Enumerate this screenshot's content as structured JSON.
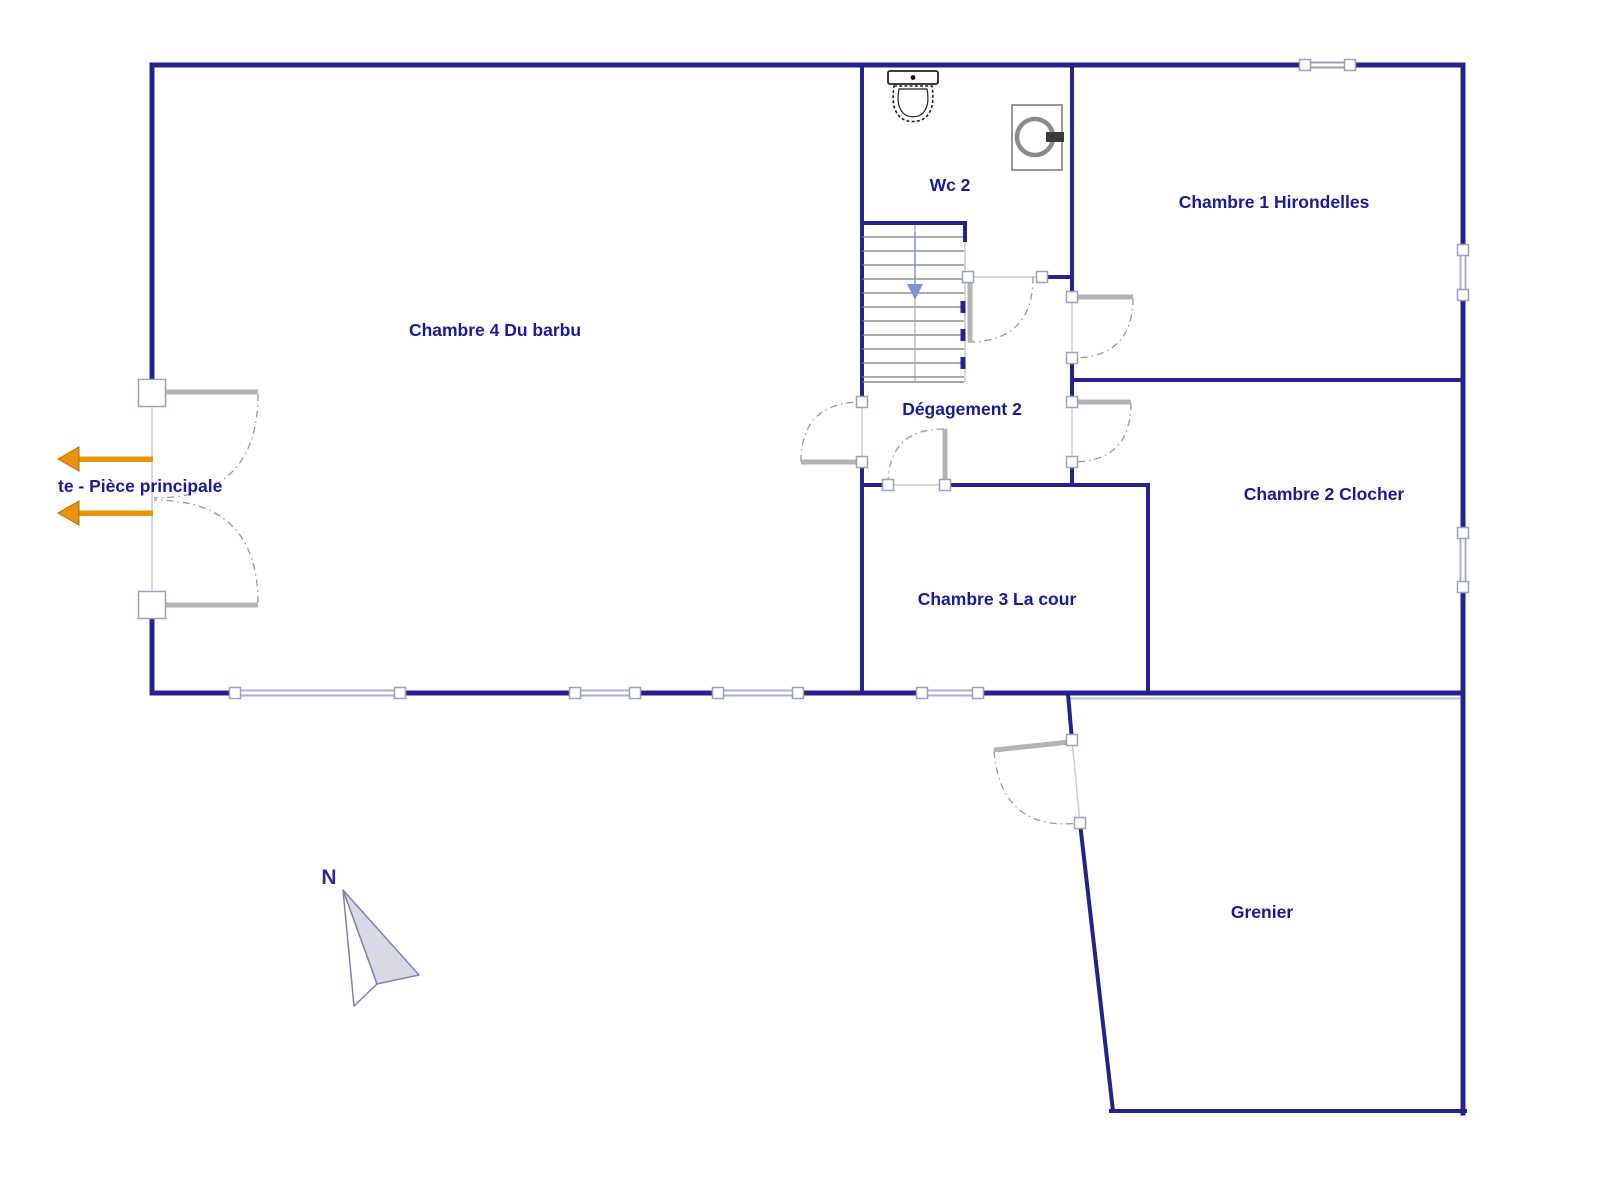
{
  "plan": {
    "type": "floor-plan",
    "rooms": {
      "chambre4": "Chambre 4 Du barbu",
      "wc2": "Wc 2",
      "chambre1": "Chambre 1 Hirondelles",
      "degagement2": "Dégagement 2",
      "chambre2": "Chambre 2 Clocher",
      "chambre3": "Chambre 3 La cour",
      "grenier": "Grenier"
    },
    "entry_label": "te - Pièce principale",
    "compass_label": "N",
    "fixtures": [
      "toilet-icon",
      "washing-machine-icon",
      "staircase-down",
      "north-arrow-icon",
      "exit-arrow-icon"
    ],
    "colors": {
      "wall": "#23238f",
      "label_text": "#1b1b99",
      "door_leaf": "#b3b3b3",
      "door_arc": "#999999",
      "window": "#a8aed8",
      "exit_arrow": "#e8930c",
      "stair_arrow": "#7b96d8",
      "compass_fill": "#d9d9e6"
    }
  }
}
